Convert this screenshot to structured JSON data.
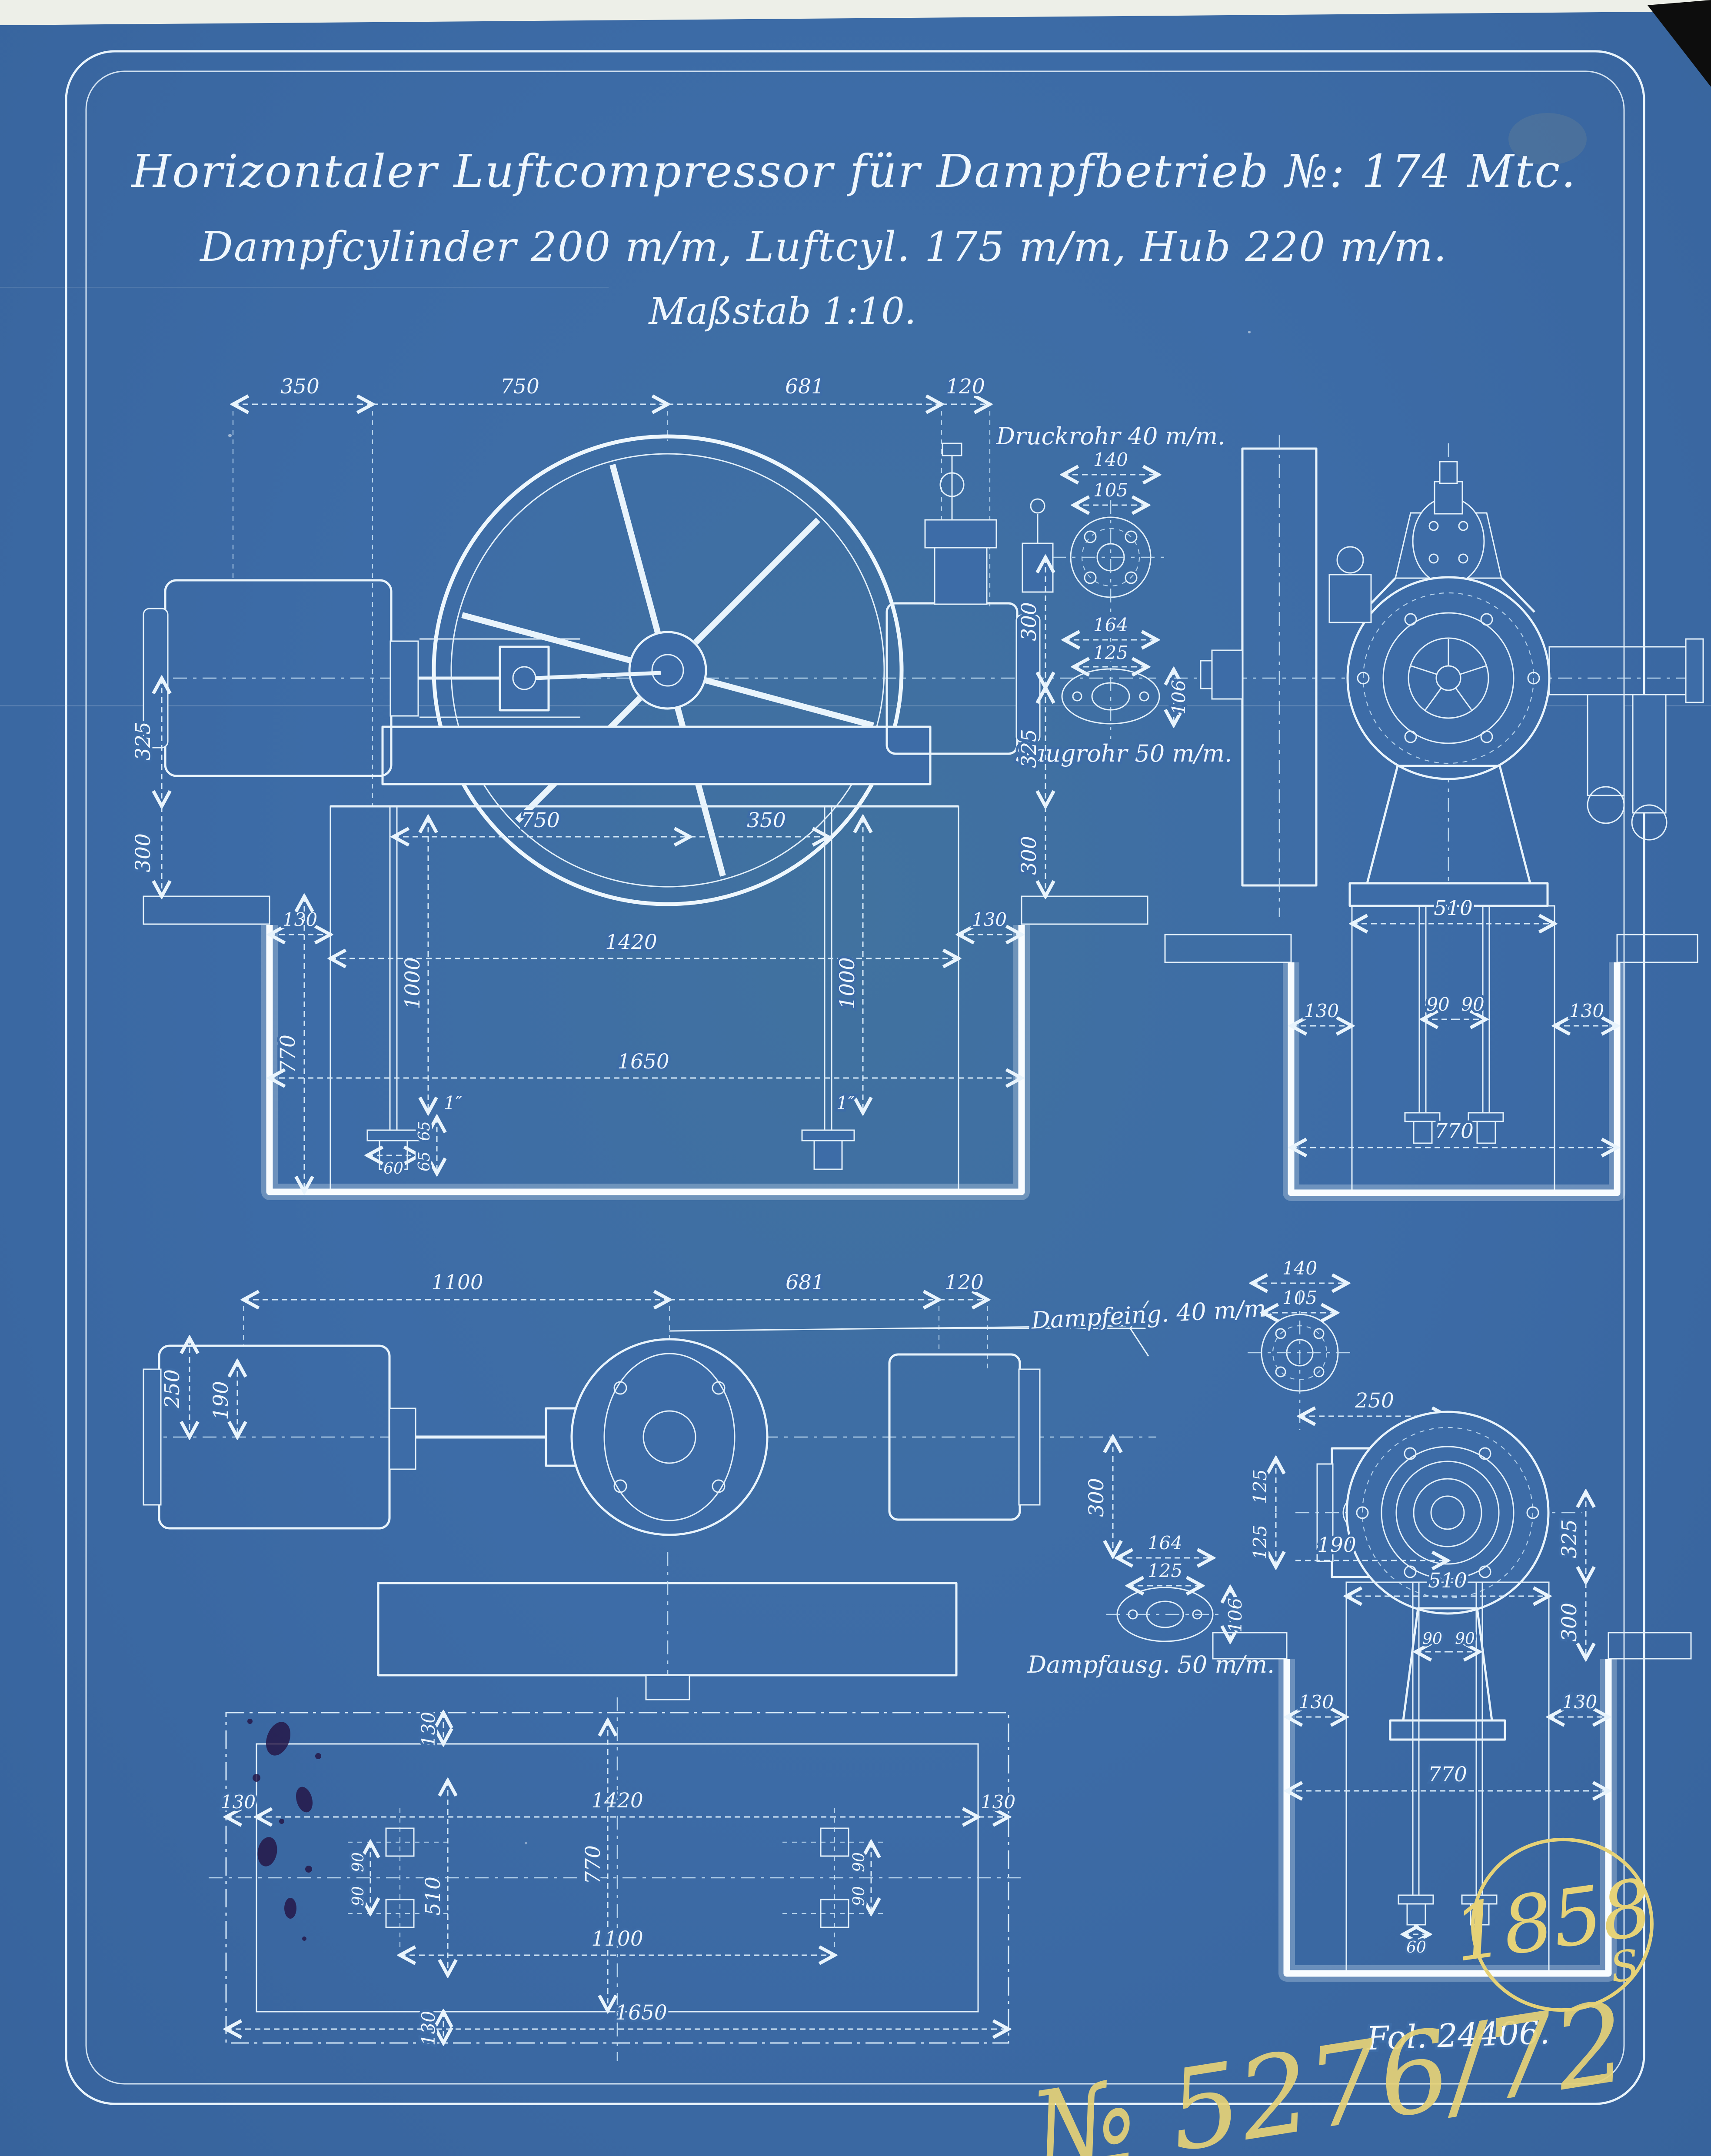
{
  "title": {
    "line1": "Horizontaler Luftcompressor für Dampfbetrieb №: 174 Mtc.",
    "line2": "Dampfcylinder 200 m/m, Luftcyl. 175 m/m, Hub 220 m/m.",
    "line3": "Maßstab 1:10."
  },
  "labels": {
    "druckrohr": "Druckrohr 40 m/m.",
    "saugrohr": "Saugrohr 50 m/m.",
    "dampfeing": "Dampfeing. 40 m/m.",
    "dampfausg": "Dampfausg. 50 m/m."
  },
  "annotations": {
    "archive_number": "1858",
    "archive_suffix": "S",
    "folio": "Fol. 24406.",
    "register_number": "№ 5276/72"
  },
  "dims": {
    "side_top": [
      "350",
      "750",
      "681",
      "120"
    ],
    "side_left": [
      "325",
      "300"
    ],
    "side_foundation": [
      "130",
      "770",
      "1000",
      "750",
      "350",
      "1420",
      "1000",
      "130",
      "1650",
      "60",
      "65",
      "65",
      "1″",
      "1″"
    ],
    "pipe_detail": [
      "140",
      "105",
      "300",
      "164",
      "125",
      "106",
      "325",
      "300"
    ],
    "end_top": [
      "510",
      "130",
      "90",
      "90",
      "130",
      "770"
    ],
    "plan": [
      "1100",
      "681",
      "120",
      "250",
      "190",
      "300"
    ],
    "plan_foundation": [
      "130",
      "130",
      "1420",
      "130",
      "510",
      "770",
      "90",
      "90",
      "90",
      "90",
      "1100",
      "130",
      "1650"
    ],
    "steam_detail": [
      "140",
      "105",
      "250",
      "125",
      "125",
      "164",
      "125",
      "106",
      "190"
    ],
    "end_bottom": [
      "510",
      "90",
      "90",
      "130",
      "130",
      "325",
      "300",
      "770",
      "60"
    ]
  },
  "colors": {
    "paper": "#3d6ca7",
    "line": "#e9f4fc",
    "pencil": "#e6d277",
    "ink": "#241343"
  }
}
